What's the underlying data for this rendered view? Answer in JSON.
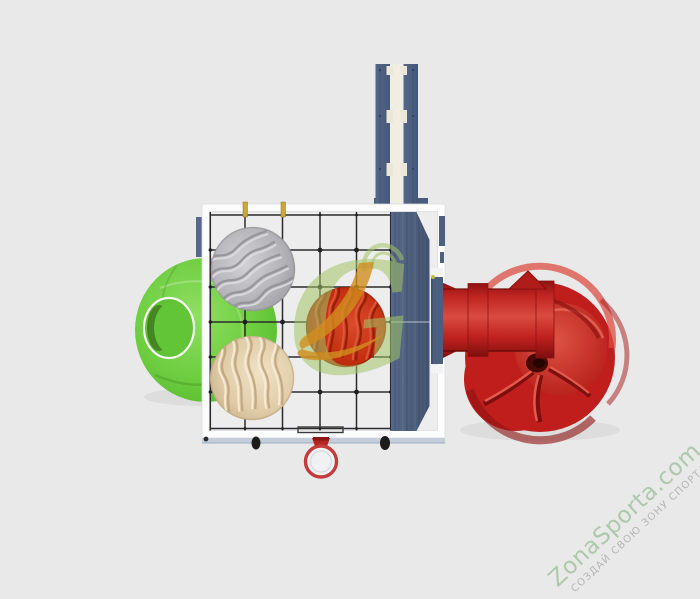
{
  "meta": {
    "width": 700,
    "height": 599,
    "background_color": "#e9e9e9",
    "view": "top-down product render"
  },
  "watermark": {
    "brand": "ZonaSporta.com",
    "slogan": "СОЗДАЙ СВОЮ ЗОНУ СПОРТА",
    "brand_color": "#adc8ad",
    "slogan_color": "#b5b5b5",
    "rotation_deg": -43
  },
  "logo_watermark": {
    "letter": "G",
    "green": "#a3c566",
    "orange": "#d18d1e"
  },
  "palette": {
    "frame_white": "#fcfcfd",
    "net_black": "#2c2c2c",
    "wood_navy": "#4d5f80",
    "plank_gap_cream": "#f1ede1",
    "dome_green": "#6fce41",
    "boulder_gray": "#b4b4b8",
    "boulder_beige": "#e0cca8",
    "boulder_red": "#c32f10",
    "slide_red": "#c32020",
    "hoop_red": "#c53a3a",
    "peg_yellow": "#c9a63e",
    "bottom_rail_blue": "#c3ceda"
  },
  "scene": {
    "product": "children playground climbing complex, top view",
    "components": [
      "rope climbing net with white frame",
      "green climbing dome with entry hole",
      "gray climbing boulder",
      "beige climbing boulder",
      "red climbing boulder",
      "wooden tower deck",
      "double balance planks",
      "red spiral tube slide",
      "basketball hoop"
    ]
  }
}
